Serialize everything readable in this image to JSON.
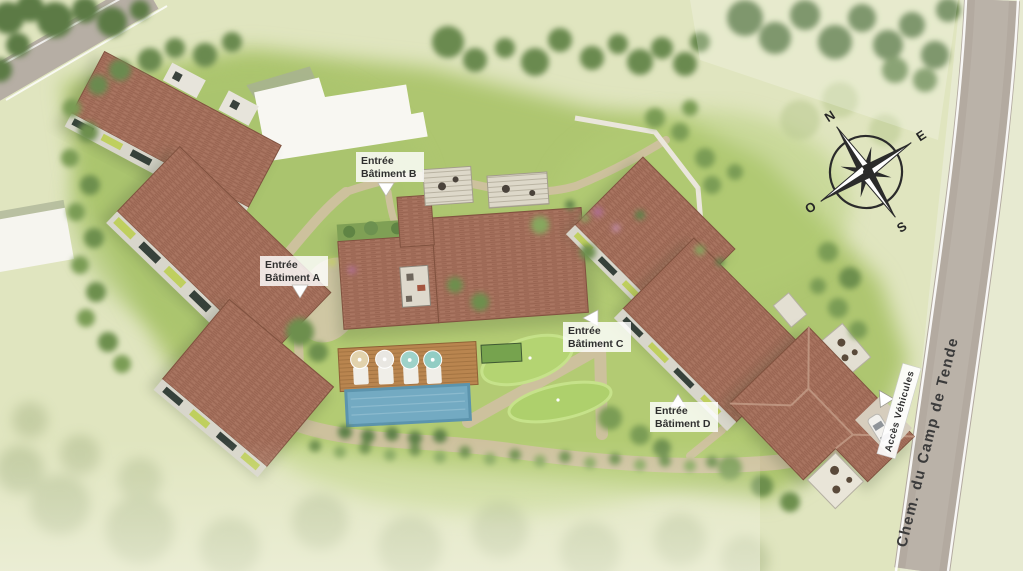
{
  "map": {
    "labels": {
      "entrance_b": {
        "line1": "Entrée",
        "line2": "Bâtiment B"
      },
      "entrance_a": {
        "line1": "Entrée",
        "line2": "Bâtiment A"
      },
      "entrance_c": {
        "line1": "Entrée",
        "line2": "Bâtiment C"
      },
      "entrance_d": {
        "line1": "Entrée",
        "line2": "Bâtiment D"
      },
      "vehicle_access": "Accès Véhicules",
      "road_name": "Chem. du Camp de Tende"
    },
    "compass": {
      "north": "N",
      "east": "E",
      "south": "S",
      "west": "O"
    },
    "colors": {
      "grass_outer": "#e0e5bf",
      "grass_site": "#aec66f",
      "tree_dark": "#5c7a45",
      "tree_mid": "#7a9c55",
      "roof": "#a5705c",
      "roof_line": "#8d5a49",
      "road": "#b3aaa0",
      "path": "#cfc1a0",
      "pool": "#73aac2",
      "deck": "#b9854f",
      "white_building": "#f8f7f2",
      "label_bg": "#ffffff",
      "label_text": "#2f2f2f"
    }
  }
}
